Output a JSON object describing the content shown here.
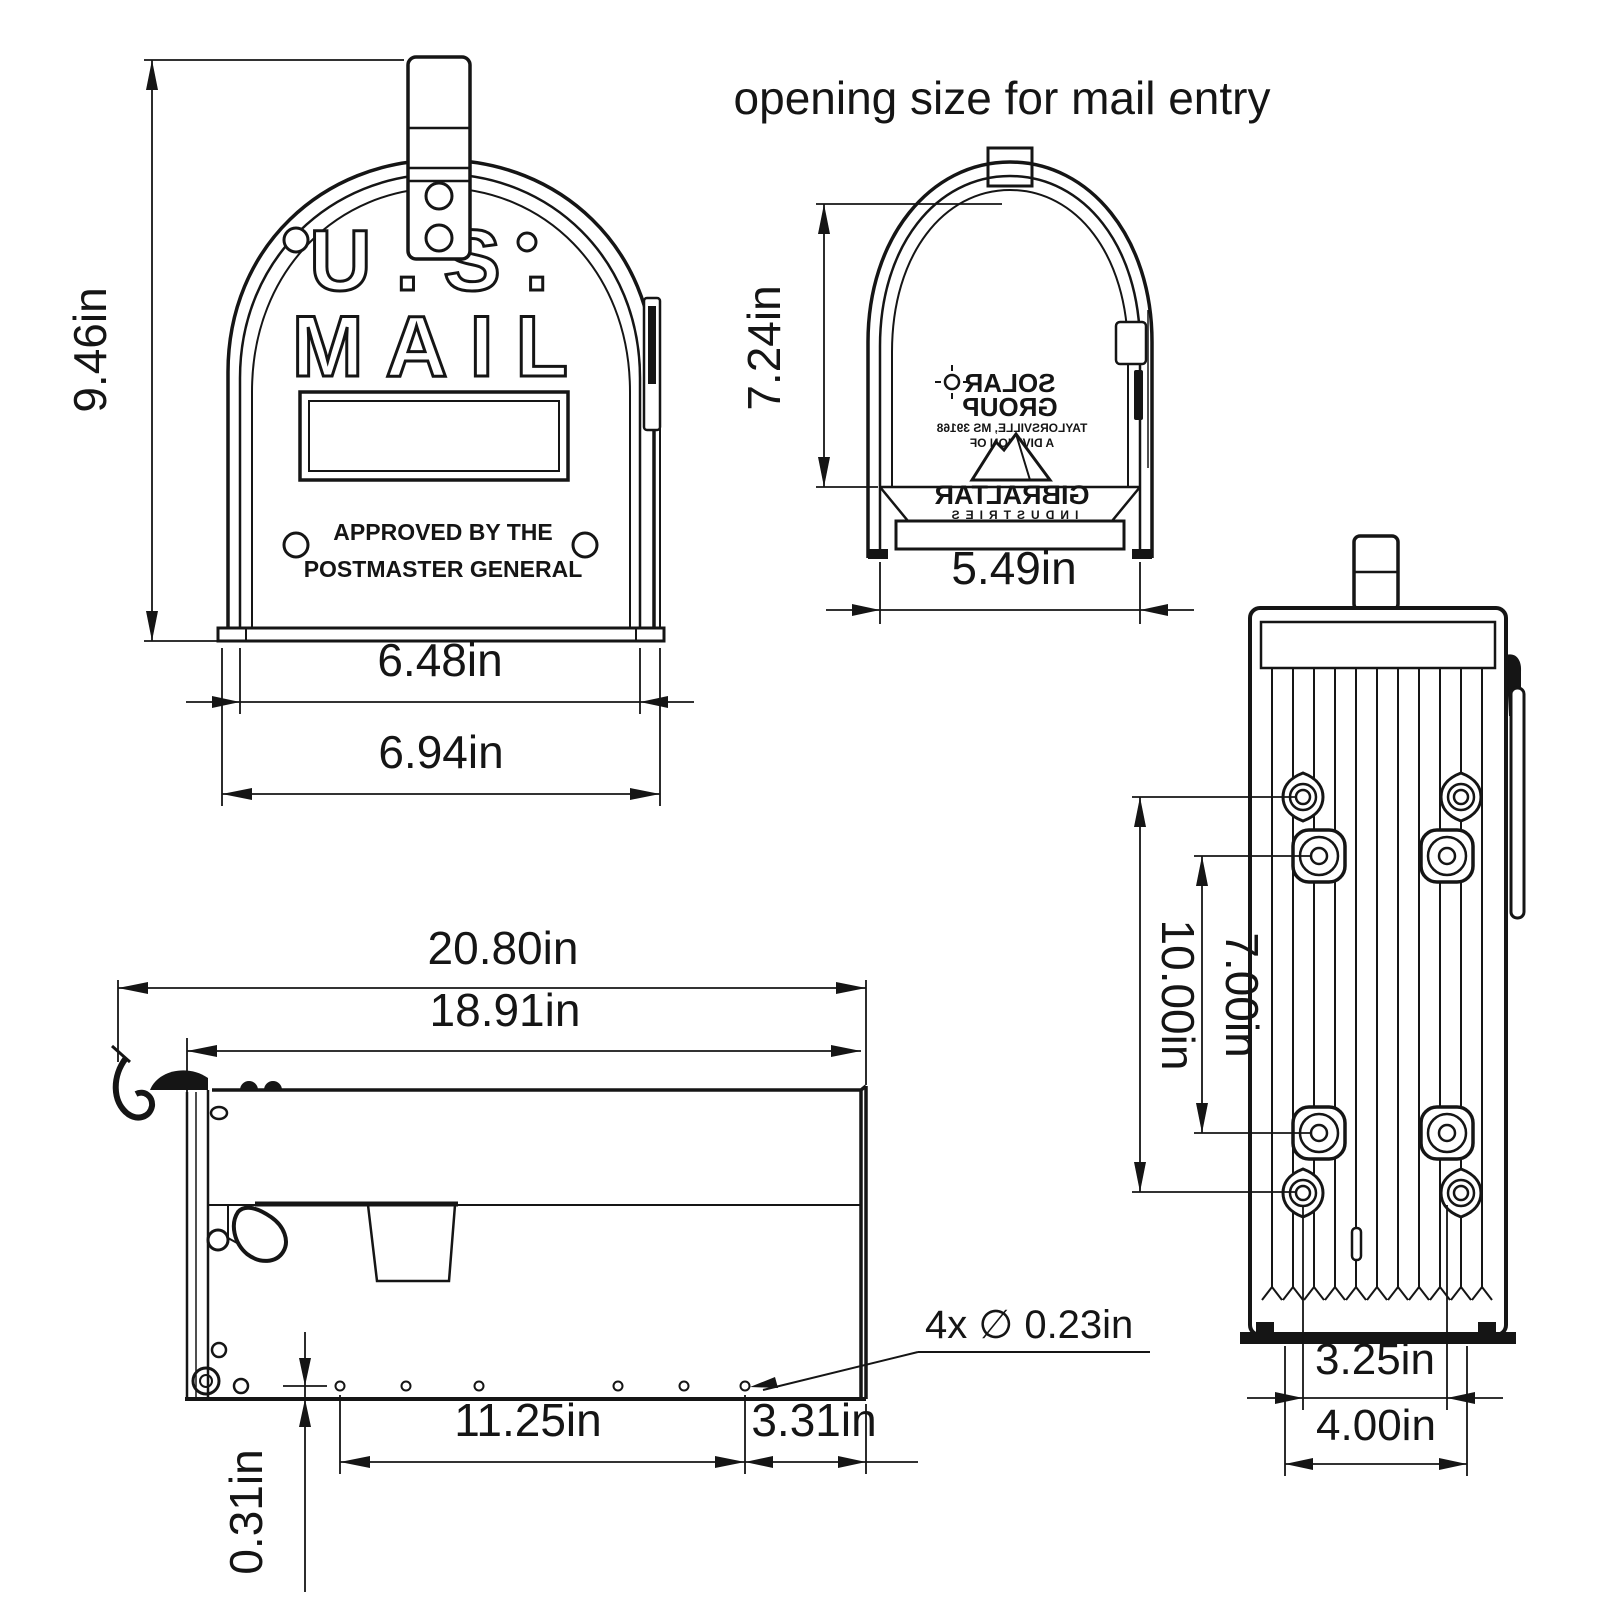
{
  "title": "opening size for mail entry",
  "front_view": {
    "emboss": {
      "line1": "U.S.",
      "line2": "MAIL"
    },
    "approved": {
      "line1": "APPROVED BY THE",
      "line2": "POSTMASTER GENERAL"
    },
    "dims": {
      "height": "9.46in",
      "door_width": "6.48in",
      "overall_width": "6.94in"
    }
  },
  "opening_view": {
    "dims": {
      "height": "7.24in",
      "width": "5.49in"
    },
    "inside_label": {
      "line1": "SOLAR",
      "line2": "GROUP",
      "line3": "TAYLORSVILLE, MS 39168",
      "line4": "A DIVISION OF",
      "line5": "GIBRALTAR",
      "line6": "INDUSTRIES"
    }
  },
  "bottom_view": {
    "dims": {
      "outer_holes": "10.00in",
      "inner_holes": "7.00in",
      "slots_inner": "3.25in",
      "slots_outer": "4.00in"
    }
  },
  "side_view": {
    "dims": {
      "overall": "20.80in",
      "body": "18.91in",
      "holes_span": "11.25in",
      "rear": "3.31in",
      "edge_offset": "0.31in",
      "callout": "4x ∅ 0.23in"
    }
  }
}
